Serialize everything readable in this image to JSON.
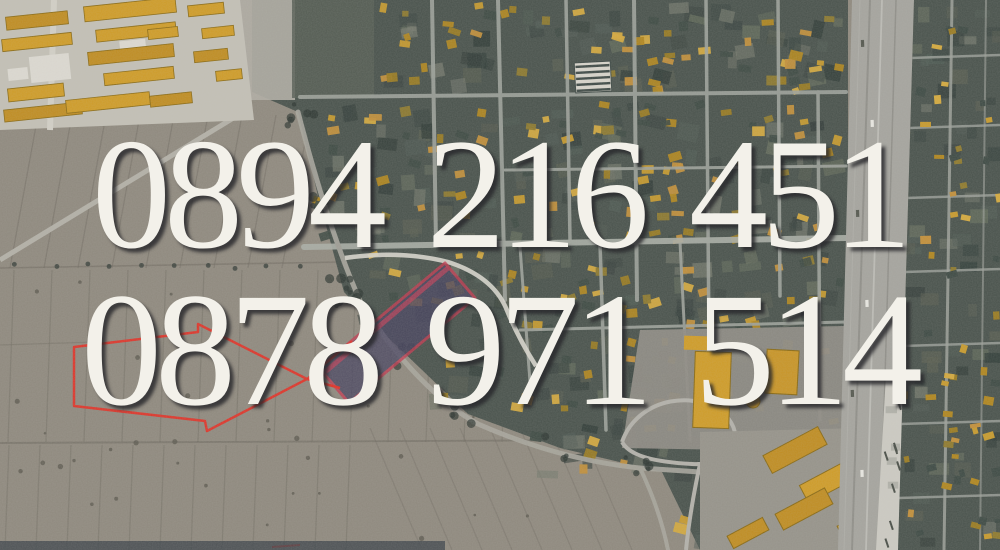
{
  "overlay": {
    "phone_primary": "0894 216 451",
    "phone_secondary": "0878 971 514",
    "text_color": "#f3f1ea",
    "shadow_color": "#28282c"
  },
  "map": {
    "view": "aerial-satellite",
    "colors": {
      "field": "#8f897e",
      "field_line": "#6e6960",
      "village_ground": "#49524c",
      "house_orange": "#c79a2d",
      "industrial_ground": "#c3c0b6",
      "road": "#9ea29b",
      "road_bright": "#aaaea6",
      "highway": "#a5a49e",
      "parcel_fill": "#484460",
      "parcel_border": "#c23a50",
      "arrow_red": "#e03328",
      "path_white": "#d8d6cd",
      "vegetation": "#2c3531"
    }
  }
}
